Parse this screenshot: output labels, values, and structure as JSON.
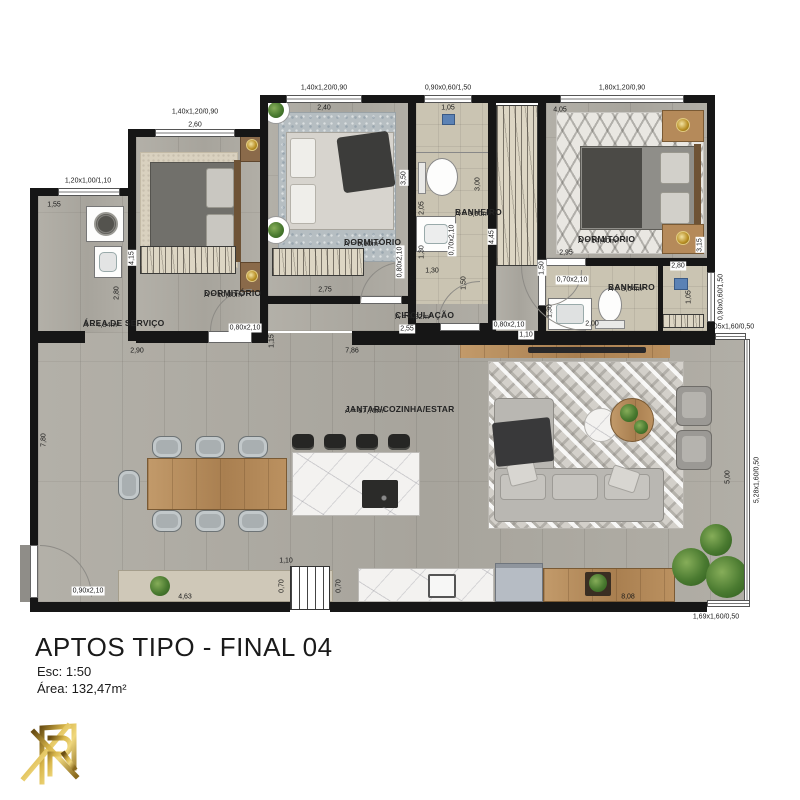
{
  "title_block": {
    "title": "APTOS TIPO -  FINAL 04",
    "scale": "Esc: 1:50",
    "area": "Área: 132,47m²"
  },
  "rooms": {
    "service": {
      "name": "ÁREA DE SERVIÇO",
      "area": "A = 4,34m²"
    },
    "dorm1": {
      "name": "DORMITÓRIO",
      "area": "A = 10,80m²"
    },
    "dorm2": {
      "name": "DORMITÓRIO",
      "area": "A = 9,10m²"
    },
    "dorm3": {
      "name": "DORMITÓRIO",
      "area": "A = 14,40m²"
    },
    "bath1": {
      "name": "BANHEIRO",
      "area": "A = 3,90m²"
    },
    "bath2": {
      "name": "BANHEIRO",
      "area": "A = 3,64m²"
    },
    "circulation": {
      "name": "CIRCULAÇÃO",
      "area": "A = 4,92m²"
    },
    "living": {
      "name": "JANTAR/COZINHA/ESTAR",
      "area": "A = 67,75m²"
    }
  },
  "openings": {
    "windows": [
      {
        "label": "1,40x1,20/0,90"
      },
      {
        "label": "1,40x1,20/0,90"
      },
      {
        "label": "0,90x0,60/1,50"
      },
      {
        "label": "1,80x1,20/0,90"
      },
      {
        "label": "1,20x1,00/1,10"
      },
      {
        "label": "0,90x0,60/1,50"
      },
      {
        "label": "1,05x1,60/0,50"
      },
      {
        "label": "5,28x1,60/0,50"
      },
      {
        "label": "1,69x1,60/0,50"
      }
    ],
    "doors": [
      {
        "label": "0,80x2,10"
      },
      {
        "label": "0,80x2,10"
      },
      {
        "label": "0,70x2,10"
      },
      {
        "label": "0,80x2,10"
      },
      {
        "label": "0,70x2,10"
      },
      {
        "label": "0,90x2,10"
      }
    ]
  },
  "dimensions": [
    {
      "t": "2,60"
    },
    {
      "t": "2,40"
    },
    {
      "t": "1,05"
    },
    {
      "t": "4,05"
    },
    {
      "t": "1,55"
    },
    {
      "t": "4,15"
    },
    {
      "t": "2,80"
    },
    {
      "t": "2,90"
    },
    {
      "t": "7,80"
    },
    {
      "t": "1,15"
    },
    {
      "t": "2,75"
    },
    {
      "t": "3,50"
    },
    {
      "t": "0,90"
    },
    {
      "t": "2,05"
    },
    {
      "t": "1,30"
    },
    {
      "t": "1,30"
    },
    {
      "t": "3,00"
    },
    {
      "t": "1,50"
    },
    {
      "t": "4,45"
    },
    {
      "t": "1,10"
    },
    {
      "t": "2,95"
    },
    {
      "t": "1,50"
    },
    {
      "t": "2,00"
    },
    {
      "t": "1,30"
    },
    {
      "t": "3,15"
    },
    {
      "t": "2,80"
    },
    {
      "t": "1,05"
    },
    {
      "t": "2,55"
    },
    {
      "t": "7,86"
    },
    {
      "t": "5,00"
    },
    {
      "t": "4,63"
    },
    {
      "t": "8,08"
    },
    {
      "t": "1,10"
    },
    {
      "t": "0,70"
    },
    {
      "t": "0,70"
    }
  ]
}
